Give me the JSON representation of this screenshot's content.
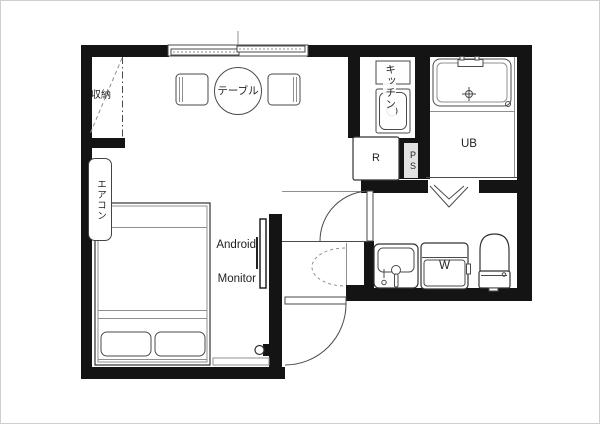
{
  "page": {
    "background": "#ffffff",
    "type": "apartment floor plan"
  },
  "colors": {
    "wall": "#141414",
    "line": "#4a4a4a",
    "line_light": "#8f8f8f",
    "text": "#1f1f1f",
    "bg": "#ffffff"
  },
  "labels": {
    "storage": "収納",
    "table": "テーブル",
    "kitchen": "キッチン",
    "refrigerator": "R",
    "pipe_space": "PS",
    "unit_bath": "UB",
    "aircon": "エアコン",
    "monitor_line1": "Android",
    "monitor_line2": "Monitor",
    "washer": "W"
  }
}
